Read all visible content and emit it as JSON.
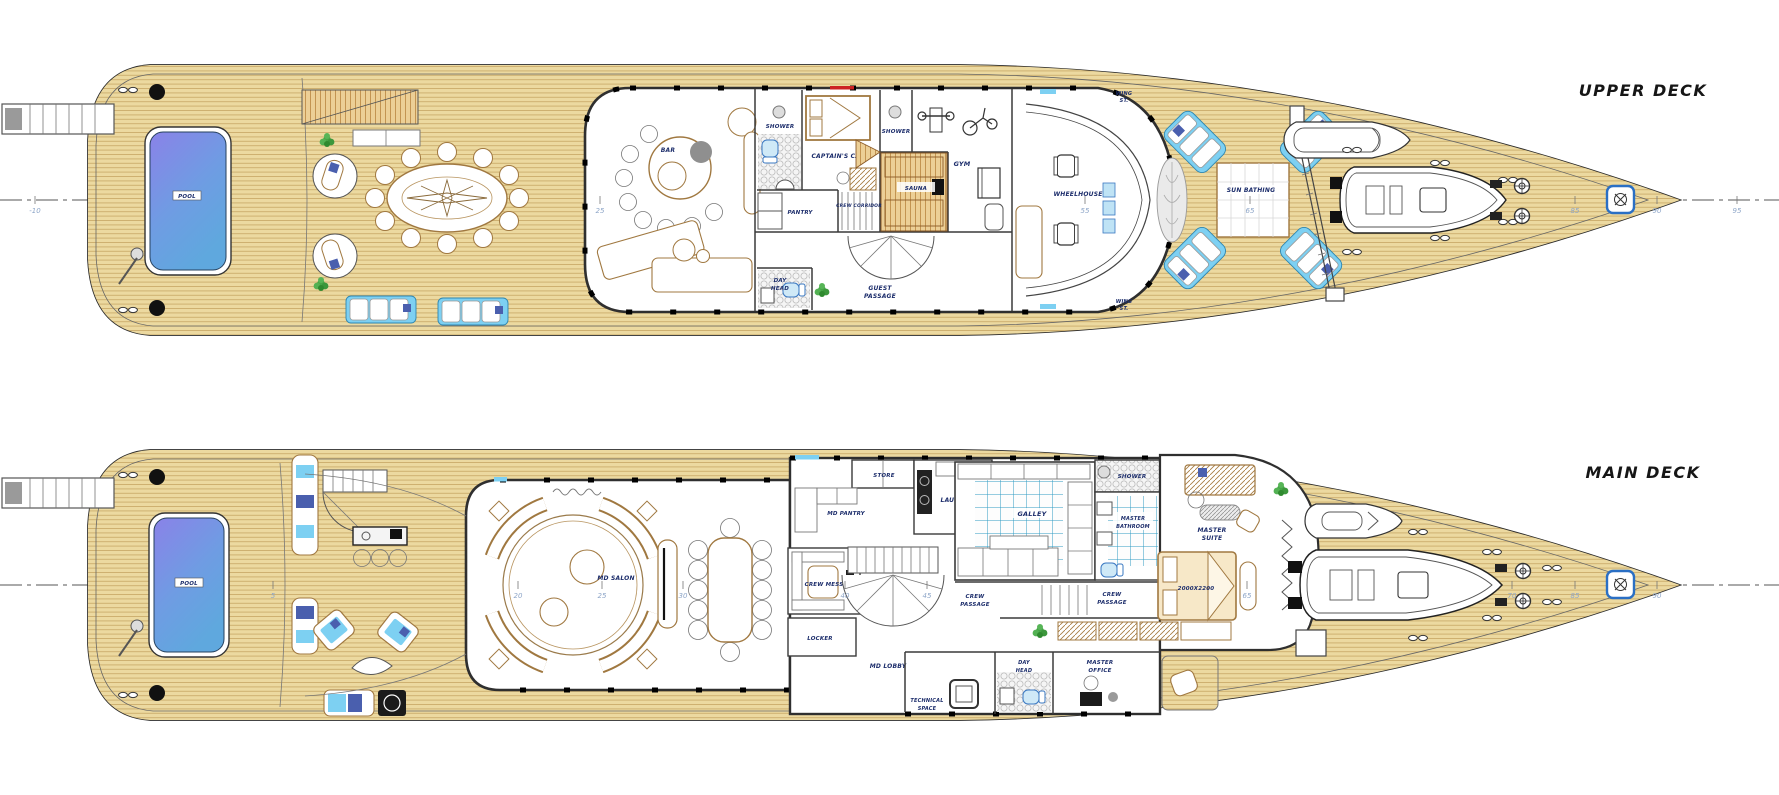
{
  "drawing": {
    "type": "yacht general arrangement plan - two decks",
    "upper": {
      "title": "UPPER DECK",
      "labels": {
        "pool": "POOL",
        "bar": "BAR",
        "shower_port": "SHOWER",
        "captains_cabin": "CAPTAIN'S CABIN",
        "shower_stbd": "SHOWER",
        "pantry": "PANTRY",
        "crew_corridor": "CREW CORRIDOR",
        "sauna": "SAUNA",
        "gym": "GYM",
        "day_head": [
          "DAY",
          "HEAD"
        ],
        "guest_passage": [
          "GUEST",
          "PASSAGE"
        ],
        "wheelhouse": "WHEELHOUSE",
        "wing_station_port": [
          "WING",
          "ST."
        ],
        "wing_station_stbd": [
          "WING",
          "ST."
        ],
        "sun_bathing": "SUN BATHING"
      },
      "stations": [
        "-10",
        "25",
        "55",
        "65",
        "85",
        "90",
        "95"
      ]
    },
    "main": {
      "title": "MAIN DECK",
      "labels": {
        "pool": "POOL",
        "md_salon": "MD SALON",
        "store": "STORE",
        "laundry": "LAUNDRY",
        "md_pantry": "MD PANTRY",
        "galley": "GALLEY",
        "crew_mess": "CREW MESS",
        "locker": "LOCKER",
        "md_lobby": "MD LOBBY",
        "crew_passage_aft": [
          "CREW",
          "PASSAGE"
        ],
        "crew_passage_fwd": [
          "CREW",
          "PASSAGE"
        ],
        "shower": "SHOWER",
        "master_bathroom": [
          "MASTER",
          "BATHROOM"
        ],
        "master_suite": [
          "MASTER",
          "SUITE"
        ],
        "bed_size": "2000X2200",
        "master_office": [
          "MASTER",
          "OFFICE"
        ],
        "technical_space": [
          "TECHNICAL",
          "SPACE"
        ],
        "day_head": [
          "DAY",
          "HEAD"
        ]
      },
      "stations": [
        "5",
        "20",
        "25",
        "30",
        "40",
        "45",
        "65",
        "70",
        "85",
        "90"
      ]
    },
    "colors": {
      "teak": "#ecd9a0",
      "teak_line": "#c3a05c",
      "pool_top": "#8a82e8",
      "pool_bottom": "#5fa8de",
      "cushion_blue": "#7dd0f2",
      "tile_blue": "#2f9cc4",
      "furniture_tan": "#a07840",
      "label_navy": "#1c2d6b"
    }
  }
}
